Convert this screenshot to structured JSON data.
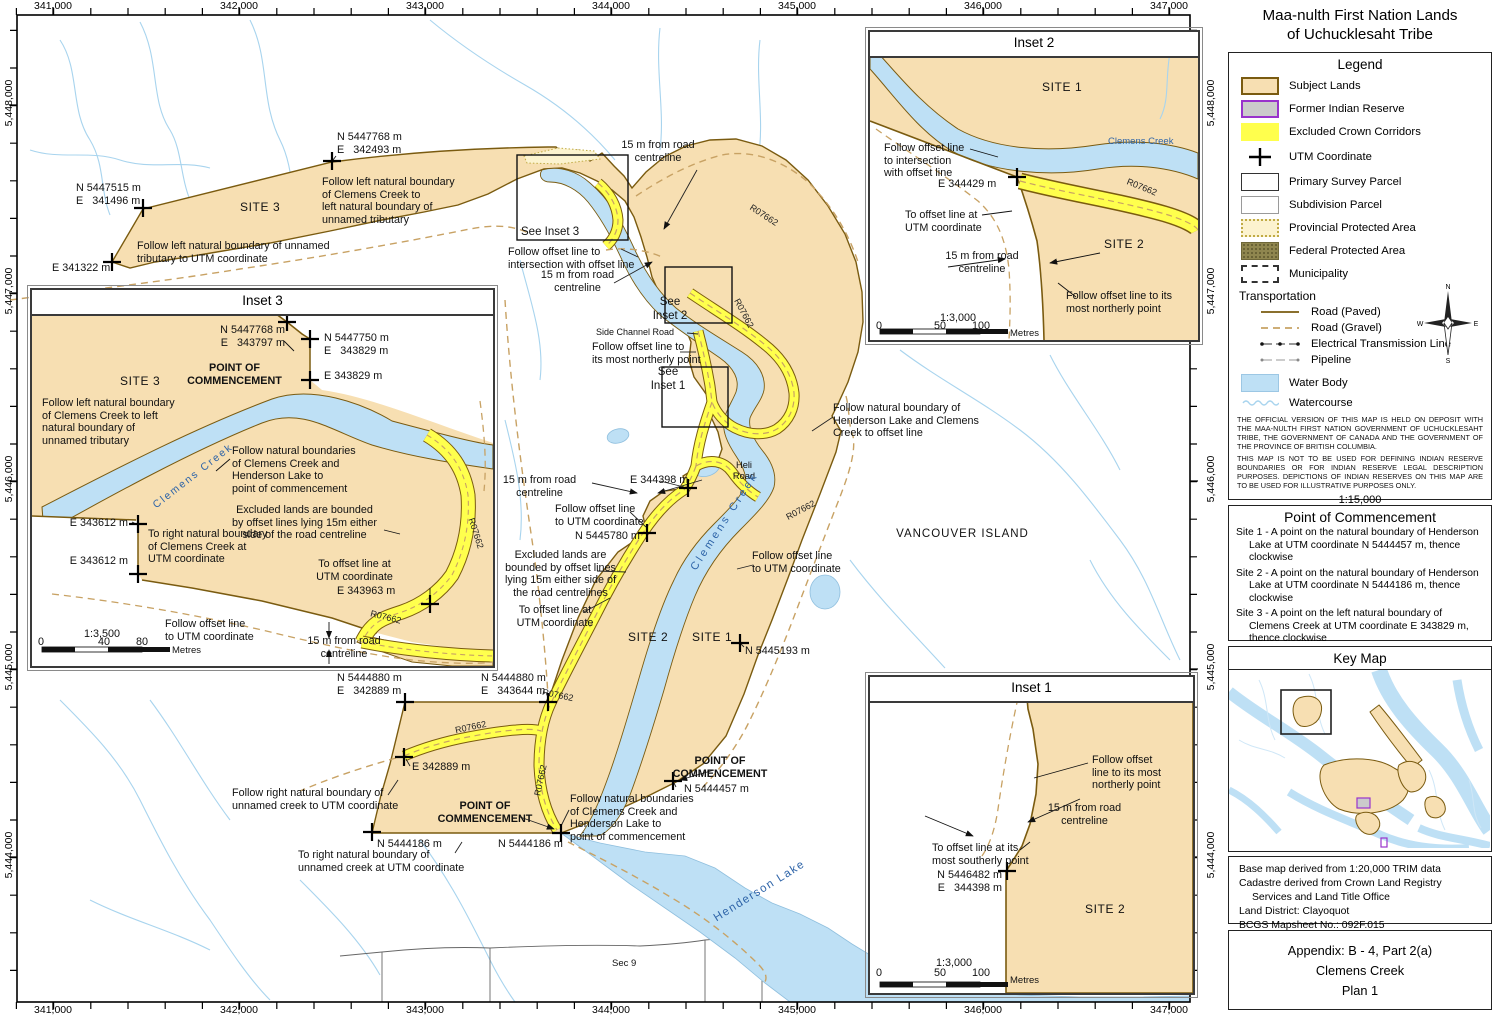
{
  "title": {
    "line1": "Maa-nulth First Nation Lands",
    "line2": "of Uchucklesaht Tribe"
  },
  "colors": {
    "subject_lands": "#F7DFB2",
    "subject_border": "#7A5B10",
    "reserve_fill": "#CBCBCB",
    "reserve_border": "#9933CC",
    "excluded_corridor": "#FFFF4D",
    "provincial_fill": "#FCF3CF",
    "federal_fill": "#8F864F",
    "water": "#BEE0F5",
    "watercourse": "#A8D4EE",
    "gravel_road": "#C8A264"
  },
  "axes": {
    "x": [
      "341,000",
      "342,000",
      "343,000",
      "344,000",
      "345,000",
      "346,000",
      "347,000"
    ],
    "y": [
      "5,448,000",
      "5,447,000",
      "5,446,000",
      "5,445,000",
      "5,444,000"
    ]
  },
  "legend": {
    "title": "Legend",
    "items": [
      {
        "label": "Subject Lands"
      },
      {
        "label": "Former Indian Reserve"
      },
      {
        "label": "Excluded Crown Corridors"
      },
      {
        "label": "UTM Coordinate"
      },
      {
        "label": "Primary Survey Parcel"
      },
      {
        "label": "Subdivision Parcel"
      },
      {
        "label": "Provincial Protected Area"
      },
      {
        "label": "Federal Protected Area"
      },
      {
        "label": "Municipality"
      }
    ],
    "transportation": "Transportation",
    "transport_items": [
      {
        "label": "Road (Paved)"
      },
      {
        "label": "Road (Gravel)"
      },
      {
        "label": "Electrical Transmission Line"
      },
      {
        "label": "Pipeline"
      }
    ],
    "water_items": [
      {
        "label": "Water Body"
      },
      {
        "label": "Watercourse"
      }
    ],
    "compass": {
      "n": "N",
      "w": "W",
      "e": "E",
      "s": "S"
    },
    "disclaimer1": "THE OFFICIAL VERSION OF THIS MAP IS HELD ON DEPOSIT WITH THE MAA-NULTH FIRST NATION GOVERNMENT OF UCHUCKLESAHT TRIBE, THE GOVERNMENT OF CANADA AND THE GOVERNMENT OF THE PROVINCE OF BRITISH COLUMBIA.",
    "disclaimer2": "THIS MAP IS NOT TO BE USED FOR DEFINING INDIAN RESERVE BOUNDARIES OR FOR INDIAN RESERVE LEGAL DESCRIPTION PURPOSES.  DEPICTIONS OF INDIAN RESERVES ON THIS MAP ARE TO BE USED FOR ILLUSTRATIVE PURPOSES ONLY.",
    "scale": {
      "ratio": "1:15,000",
      "note": "Ratio scale is correct at 22\"x17\" page size.",
      "t0": "0",
      "t1": "500",
      "t2": "1,000",
      "unit": "Metres"
    }
  },
  "poc": {
    "title": "Point of Commencement",
    "site1": "Site 1 - A point on the natural boundary of Henderson Lake at UTM coordinate N 5444457 m, thence clockwise",
    "site2": "Site 2 - A point on the natural boundary of Henderson Lake at UTM coordinate N 5444186 m, thence clockwise",
    "site3": "Site 3 - A point on the left natural boundary of Clemens Creek at UTM coordinate E 343829 m, thence clockwise"
  },
  "key_map": {
    "title": "Key Map"
  },
  "base_info": {
    "l1": "Base map derived from 1:20,000 TRIM data",
    "l2": "Cadastre derived from Crown Land Registry",
    "l3": "Services and Land Title Office",
    "l4": "Land District: Clayoquot",
    "l5": "BCGS Mapsheet No.: 092F.015",
    "l6": "UTM Zone 10"
  },
  "appendix": {
    "l1": "Appendix:  B - 4, Part 2(a)",
    "l2": "Clemens Creek",
    "l3": "Plan 1"
  },
  "map": {
    "site1": "SITE 1",
    "site2": "SITE 2",
    "site3": "SITE 3",
    "vancouver": "VANCOUVER ISLAND",
    "henderson": "Henderson Lake",
    "clemens": "Clemens Creek",
    "sec9": "Sec 9",
    "heli": "Heli\nRoad",
    "side_channel": "Side Channel Road",
    "r07662": "R07662",
    "see_i1": "See\nInset 1",
    "see_i2": "See\nInset 2",
    "see_i3": "See Inset 3",
    "poc2": "POINT OF\nCOMMENCEMENT",
    "m15": "15 m from road\ncentreline",
    "follow_left_clemens": "Follow left natural boundary\nof Clemens Creek to\nleft natural boundary of\nunnamed tributary",
    "follow_left_unnamed": "Follow left natural boundary of unnamed\ntributary to UTM coordinate",
    "follow_offset_int": "Follow offset line to\nintersection with offset line",
    "follow_offset_north": "Follow offset line to\nits most northerly point",
    "follow_nat_hend": "Follow natural boundary of\nHenderson Lake and Clemens\nCreek to offset line",
    "follow_offset_utm": "Follow offset line\nto UTM coordinate",
    "excluded": "Excluded lands are\nbounded by offset lines\nlying 15m either side of\nthe road centrelines",
    "to_offset_utm": "To offset line at\nUTM coordinate",
    "follow_right_unnamed": "Follow right natural boundary of\nunnamed creek to UTM coordinate",
    "follow_nat_bound": "Follow natural boundaries\nof Clemens Creek and\nHenderson Lake to\npoint of commencement",
    "to_right_unnamed": "To right natural boundary of\nunnamed creek at UTM coordinate",
    "c_n5447768_e342493": "N 5447768 m\nE   342493 m",
    "c_n5447515_e341496": "N 5447515 m\nE   341496 m",
    "c_e341322": "E 341322 m",
    "c_e344398": "E 344398 m",
    "c_n5445780": "N 5445780 m",
    "c_n5445193": "N 5445193 m",
    "c_n5444880_e342889": "N 5444880 m\nE   342889 m",
    "c_n5444880_e343644": "N 5444880 m\nE   343644 m",
    "c_e342889": "E 342889 m",
    "c_n5444186": "N 5444186 m",
    "c_n5444457": "N 5444457 m"
  },
  "inset1": {
    "title": "Inset 1",
    "follow_offset": "Follow offset\nline to its most\nnortherly point",
    "m15": "15 m from road\ncentreline",
    "to_offset": "To offset line at its\nmost southerly point",
    "coord": "N 5446482 m\nE   344398 m",
    "site2": "SITE 2",
    "scale": "1:3,000",
    "t0": "0",
    "t1": "50",
    "t2": "100",
    "unit": "Metres"
  },
  "inset2": {
    "title": "Inset 2",
    "site1": "SITE 1",
    "site2": "SITE 2",
    "clemens": "Clemens Creek",
    "follow_int": "Follow offset line\nto intersection\nwith offset line",
    "coord": "E 344429 m",
    "to_offset": "To offset line at\nUTM coordinate",
    "m15": "15 m from road\ncentreline",
    "follow_north": "Follow offset line to its\nmost northerly point",
    "r07662": "R07662",
    "scale": "1:3,000",
    "t0": "0",
    "t1": "50",
    "t2": "100",
    "unit": "Metres"
  },
  "inset3": {
    "title": "Inset 3",
    "c1": "N 5447768 m\nE   343797 m",
    "c2": "N 5447750 m\nE   343829 m",
    "c3": "E 343829 m",
    "poc": "POINT OF\nCOMMENCEMENT",
    "site3": "SITE 3",
    "follow_left": "Follow left natural boundary\nof Clemens Creek to left\nnatural boundary of\nunnamed tributary",
    "clemens": "Clemens Creek",
    "follow_nat": "Follow natural boundaries\nof Clemens Creek and\nHenderson Lake to\npoint of commencement",
    "e343612": "E 343612 m",
    "to_right": "To right natural boundary\nof Clemens Creek at\nUTM coordinate",
    "excluded": "Excluded lands are bounded\nby offset lines lying 15m either\nside of the road centreline",
    "to_offset": "To offset line at\nUTM coordinate",
    "e343963": "E 343963 m",
    "follow_offset": "Follow offset line\nto UTM coordinate",
    "m15": "15 m from road\ncentreline",
    "r07662": "R07662",
    "scale": "1:3,500",
    "t0": "0",
    "t1": "40",
    "t2": "80",
    "unit": "Metres"
  }
}
